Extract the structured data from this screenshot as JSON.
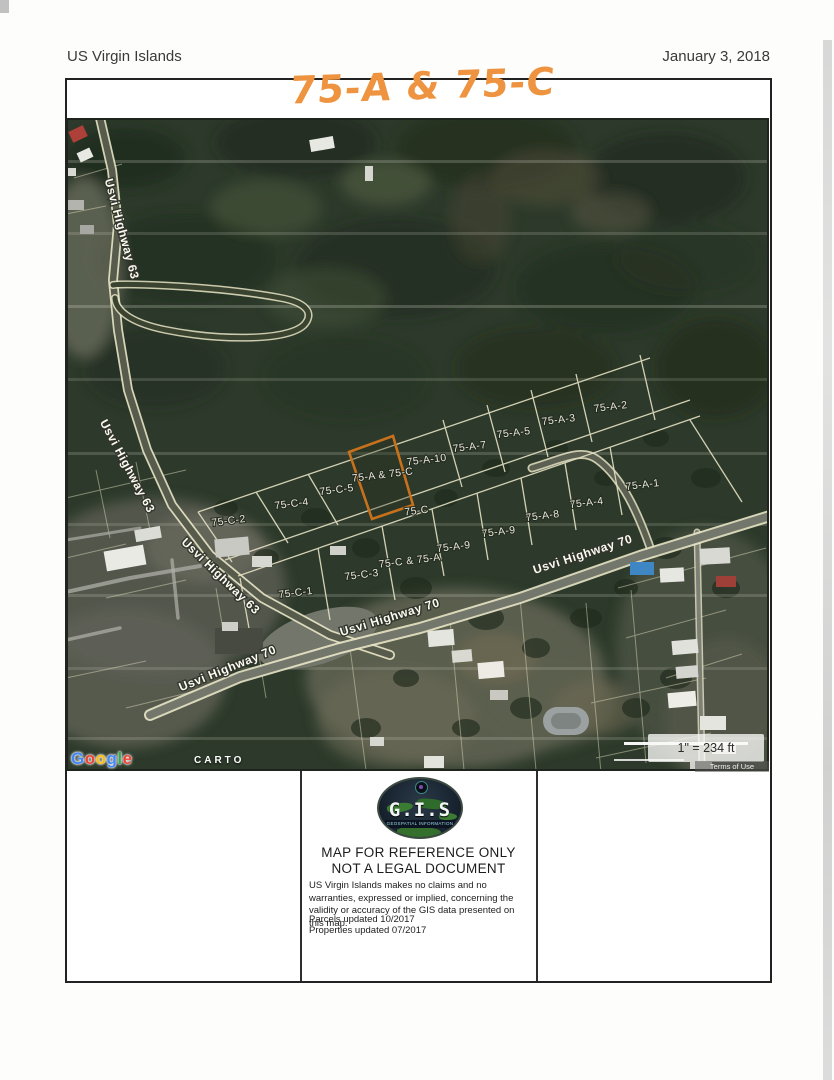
{
  "header": {
    "title": "US Virgin Islands",
    "date": "January 3, 2018"
  },
  "annotation": {
    "text": "75-A & 75-C",
    "color": "#ee9440"
  },
  "map": {
    "highlight_parcel": "75-A & 75-C",
    "highlight_color": "#c8711c",
    "scale_text": "1\" = 234 ft",
    "terms_text": "Terms of Use",
    "attribution": {
      "google": "Google",
      "google_letters": [
        {
          "ch": "G",
          "color": "#4285F4"
        },
        {
          "ch": "o",
          "color": "#EA4335"
        },
        {
          "ch": "o",
          "color": "#FBBC05"
        },
        {
          "ch": "g",
          "color": "#4285F4"
        },
        {
          "ch": "l",
          "color": "#34A853"
        },
        {
          "ch": "e",
          "color": "#EA4335"
        }
      ],
      "carto": "CARTO"
    },
    "parcel_labels": [
      {
        "text": "75-A-2",
        "x": 545,
        "y": 292
      },
      {
        "text": "75-A-3",
        "x": 493,
        "y": 305
      },
      {
        "text": "75-A-5",
        "x": 448,
        "y": 318
      },
      {
        "text": "75-A-7",
        "x": 404,
        "y": 332
      },
      {
        "text": "75-A-10",
        "x": 361,
        "y": 345
      },
      {
        "text": "75-A & 75-C",
        "x": 317,
        "y": 360
      },
      {
        "text": "75-C-5",
        "x": 271,
        "y": 375
      },
      {
        "text": "75-C-4",
        "x": 226,
        "y": 389
      },
      {
        "text": "75-C-2",
        "x": 163,
        "y": 406
      },
      {
        "text": "75-C",
        "x": 351,
        "y": 396
      },
      {
        "text": "75-A-1",
        "x": 577,
        "y": 370
      },
      {
        "text": "75-A-4",
        "x": 521,
        "y": 388
      },
      {
        "text": "75-A-8",
        "x": 477,
        "y": 401
      },
      {
        "text": "75-A-9",
        "x": 433,
        "y": 417
      },
      {
        "text": "75-A-9",
        "x": 388,
        "y": 432
      },
      {
        "text": "75-C & 75-A",
        "x": 344,
        "y": 446
      },
      {
        "text": "75-C-3",
        "x": 296,
        "y": 460
      },
      {
        "text": "75-C-1",
        "x": 230,
        "y": 478
      }
    ],
    "road_labels": [
      {
        "text": "Usvi Highway 63",
        "x": 52,
        "y": 112,
        "rot": 75
      },
      {
        "text": "Usvi Highway 63",
        "x": 58,
        "y": 350,
        "rot": 62
      },
      {
        "text": "Usvi Highway 63",
        "x": 152,
        "y": 461,
        "rot": 44
      },
      {
        "text": "Usvi Highway 70",
        "x": 325,
        "y": 503,
        "rot": -17
      },
      {
        "text": "Usvi Highway 70",
        "x": 518,
        "y": 440,
        "rot": -18
      },
      {
        "text": "Usvi Highway 70",
        "x": 163,
        "y": 554,
        "rot": -22
      }
    ]
  },
  "footer": {
    "logo_title": "G.I.S",
    "logo_subtitle": "GEOSPATIAL INFORMATION SYSTEMS",
    "line1": "MAP FOR REFERENCE ONLY",
    "line2": "NOT A LEGAL DOCUMENT",
    "disclaimer": "US Virgin Islands makes no claims and no warranties, expressed or implied, concerning the validity or accuracy of the GIS data presented on this map.",
    "updated_parcels": "Parcels updated 10/2017",
    "updated_properties": "Properties updated 07/2017"
  }
}
